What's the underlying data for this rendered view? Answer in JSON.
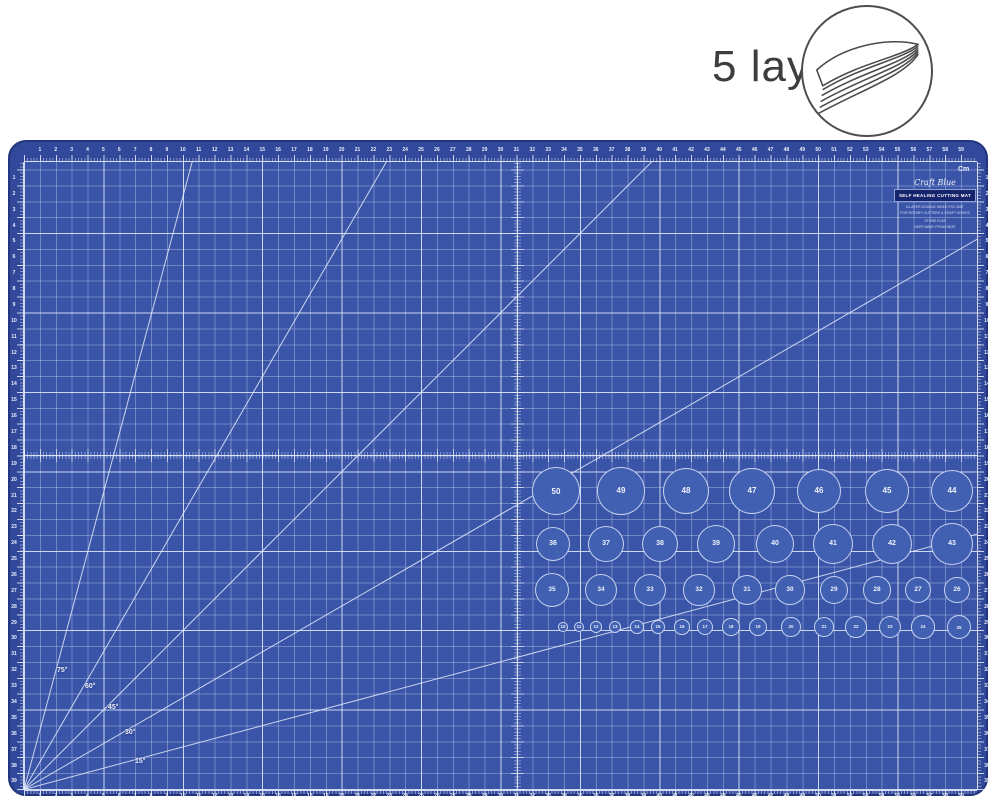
{
  "badge": {
    "label": "5 layers"
  },
  "mat": {
    "unit_label": "Cm",
    "angles": [
      {
        "label": "75°",
        "deg": 75
      },
      {
        "label": "60°",
        "deg": 60
      },
      {
        "label": "45°",
        "deg": 45
      },
      {
        "label": "30°",
        "deg": 30
      },
      {
        "label": "15°",
        "deg": 15
      }
    ],
    "rulers": {
      "h_count": 59,
      "v_count": 39
    },
    "branding": {
      "script": "Craft Blue",
      "title": "SELF HEALING CUTTING MAT",
      "lines": [
        "5-LAYER DOUBLE SIDED PVC MAT",
        "FOR ROTARY CUTTERS & CRAFT KNIVES",
        "STORE FLAT",
        "KEEP AWAY FROM HEAT"
      ]
    },
    "circle_rows": [
      {
        "values": [
          50,
          49,
          48,
          47,
          46,
          45,
          44
        ]
      },
      {
        "values": [
          36,
          37,
          38,
          39,
          40,
          41,
          42,
          43
        ]
      },
      {
        "values": [
          35,
          34,
          33,
          32,
          31,
          30,
          29,
          28,
          27,
          26
        ]
      },
      {
        "values": [
          10,
          11,
          12,
          13,
          14,
          15,
          16,
          17,
          18,
          19,
          20,
          21,
          22,
          23,
          24,
          25
        ]
      }
    ],
    "colors": {
      "mat_border_band": "#32499B",
      "grid_field": "#3A55A8",
      "title_box": "#16246E"
    }
  }
}
